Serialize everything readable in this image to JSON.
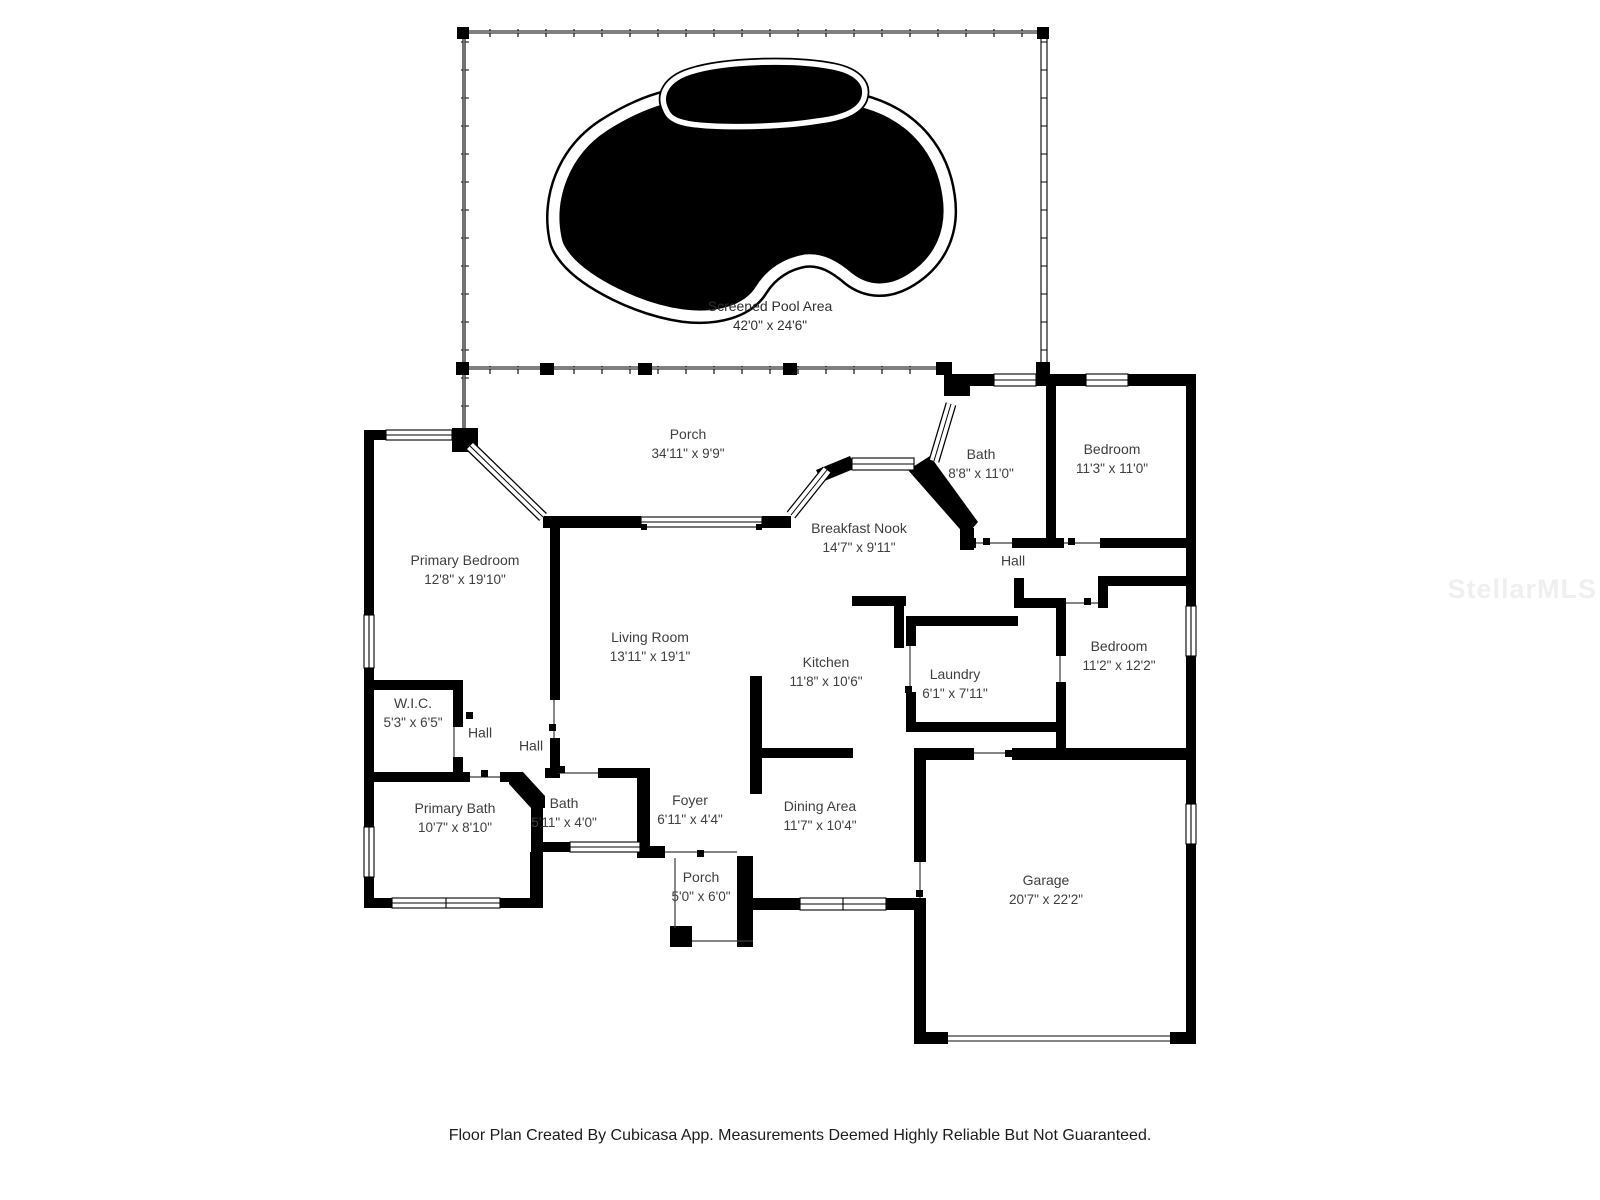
{
  "pool_area": {
    "name": "Screened Pool Area",
    "dims": "42'0\" x 24'6\""
  },
  "rooms": [
    {
      "name": "Porch",
      "dims": "34'11\" x 9'9\""
    },
    {
      "name": "Bath",
      "dims": "8'8\" x 11'0\""
    },
    {
      "name": "Bedroom",
      "dims": "11'3\" x 11'0\""
    },
    {
      "name": "Breakfast Nook",
      "dims": "14'7\" x 9'11\""
    },
    {
      "name": "Hall",
      "dims": ""
    },
    {
      "name": "Primary Bedroom",
      "dims": "12'8\" x 19'10\""
    },
    {
      "name": "Living Room",
      "dims": "13'11\" x 19'1\""
    },
    {
      "name": "Kitchen",
      "dims": "11'8\" x 10'6\""
    },
    {
      "name": "Laundry",
      "dims": "6'1\" x 7'11\""
    },
    {
      "name": "Bedroom",
      "dims": "11'2\" x 12'2\""
    },
    {
      "name": "W.I.C.",
      "dims": "5'3\" x 6'5\""
    },
    {
      "name": "Hall",
      "dims": ""
    },
    {
      "name": "Hall",
      "dims": ""
    },
    {
      "name": "Primary Bath",
      "dims": "10'7\" x 8'10\""
    },
    {
      "name": "Bath",
      "dims": "5'11\" x 4'0\""
    },
    {
      "name": "Foyer",
      "dims": "6'11\" x 4'4\""
    },
    {
      "name": "Dining Area",
      "dims": "11'7\" x 10'4\""
    },
    {
      "name": "Porch",
      "dims": "5'0\" x 6'0\""
    },
    {
      "name": "Garage",
      "dims": "20'7\" x 22'2\""
    }
  ],
  "footer": {
    "text": "Floor Plan Created By Cubicasa App. Measurements Deemed Highly Reliable But Not Guaranteed."
  },
  "watermark": {
    "text": "StellarMLS"
  },
  "colors": {
    "wall": "#000000",
    "pool": "#000000",
    "label_text": "#3e3e3e",
    "watermark": "#efefef"
  }
}
